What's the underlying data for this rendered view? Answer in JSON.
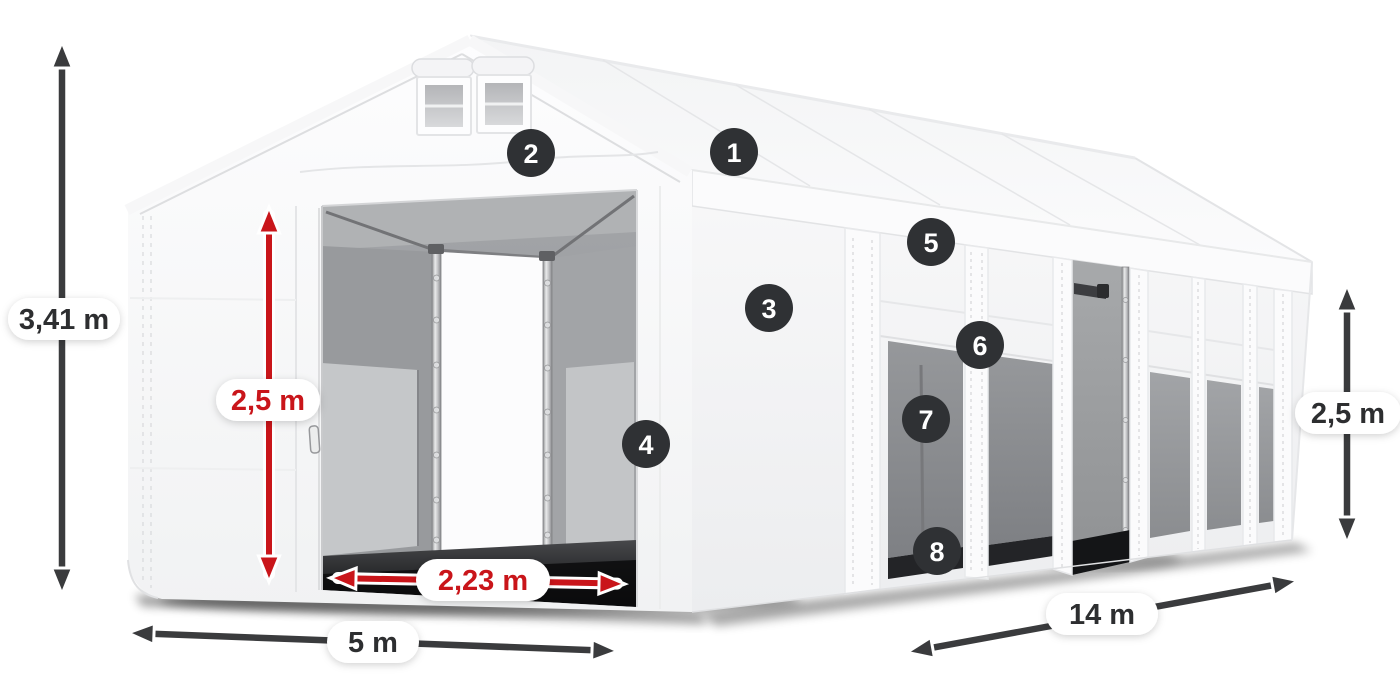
{
  "diagram": {
    "subject": "white storage tent with open front entrance, roof vents and side windows"
  },
  "dims": {
    "total_height": "3,41 m",
    "entrance_height": "2,5 m",
    "entrance_width": "2,23 m",
    "width": "5 m",
    "length": "14 m",
    "side_height": "2,5 m"
  },
  "callouts": [
    "1",
    "2",
    "3",
    "4",
    "5",
    "6",
    "7",
    "8"
  ],
  "colors": {
    "accent_red": "#c9151a",
    "arrow_dark": "#3a3b3d",
    "badge_bg": "#2f3134",
    "badge_text": "#ffffff",
    "label_dark": "#2d2e30"
  }
}
